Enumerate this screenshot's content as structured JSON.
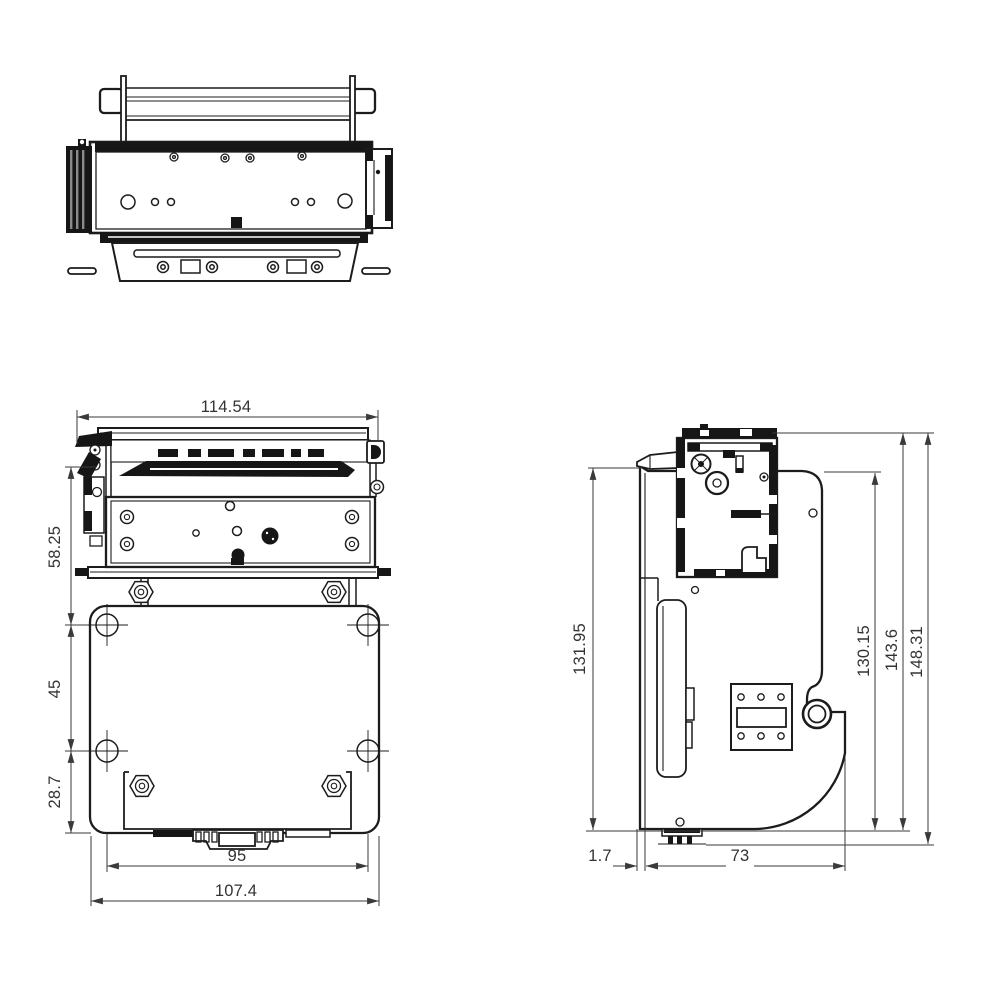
{
  "page": {
    "background": "#ffffff"
  },
  "colors": {
    "line": "#1c1c1c",
    "dimension": "#3a3a3a"
  },
  "dimensions": {
    "front_view": {
      "overall_width": "114.54",
      "upper_height": "58.25",
      "hole_spacing_vertical": "45",
      "lower_height": "28.7",
      "hole_spacing_horizontal": "95",
      "plate_width": "107.4"
    },
    "side_view": {
      "bracket_height": "131.95",
      "plate_height": "130.15",
      "body_height": "143.6",
      "overall_height": "148.31",
      "plate_offset": "1.7",
      "base_depth": "73"
    }
  }
}
